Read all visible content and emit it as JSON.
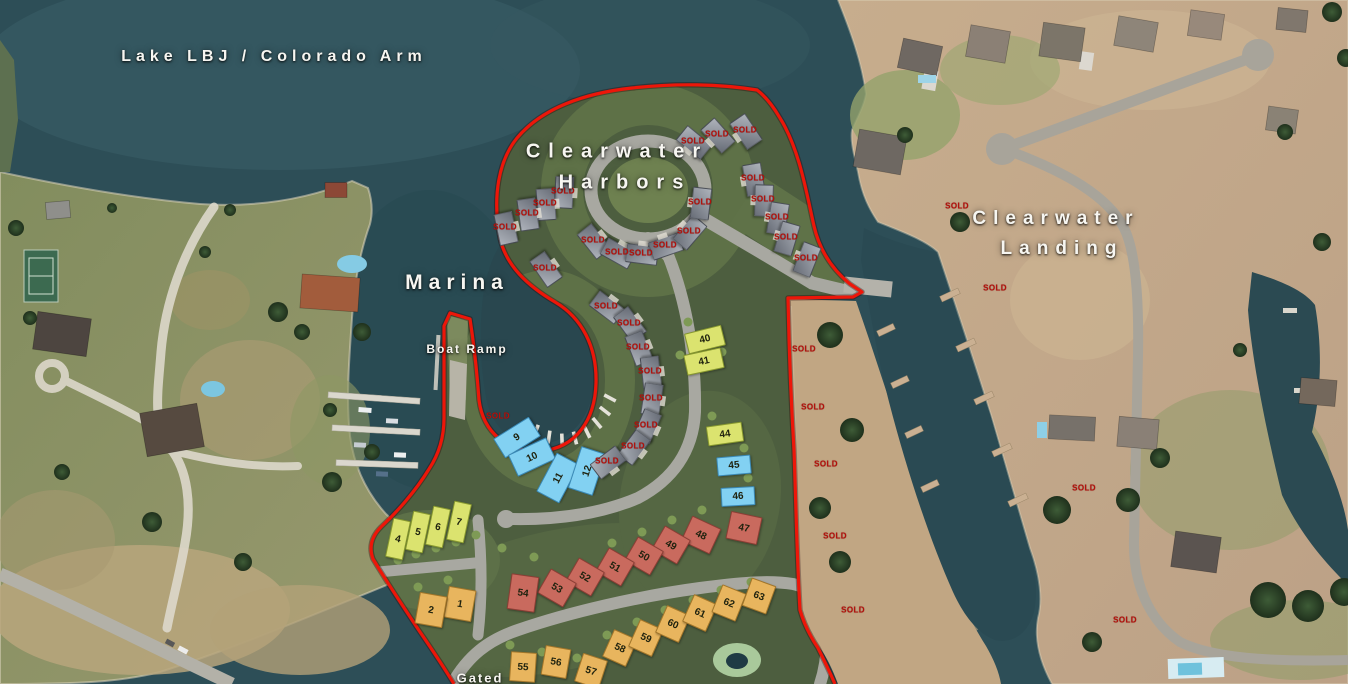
{
  "title_labels": [
    {
      "id": "lake-name",
      "text": "Lake LBJ / Colorado Arm",
      "x": 274,
      "y": 57,
      "fs": 16,
      "ls": 5
    },
    {
      "id": "harbors-line1",
      "text": "Clearwater",
      "x": 617,
      "y": 152,
      "fs": 20,
      "ls": 8
    },
    {
      "id": "harbors-line2",
      "text": "Harbors",
      "x": 625,
      "y": 183,
      "fs": 20,
      "ls": 8
    },
    {
      "id": "landing-line1",
      "text": "Clearwater",
      "x": 1056,
      "y": 219,
      "fs": 19,
      "ls": 7
    },
    {
      "id": "landing-line2",
      "text": "Landing",
      "x": 1062,
      "y": 249,
      "fs": 19,
      "ls": 7
    },
    {
      "id": "marina",
      "text": "Marina",
      "x": 457,
      "y": 283,
      "fs": 21,
      "ls": 6
    },
    {
      "id": "boat-ramp",
      "text": "Boat Ramp",
      "x": 467,
      "y": 349,
      "fs": 12,
      "ls": 2
    },
    {
      "id": "gated",
      "text": "Gated",
      "x": 480,
      "y": 678,
      "fs": 13,
      "ls": 2
    }
  ],
  "sold": {
    "text": "SOLD",
    "labels": [
      {
        "x": 693,
        "y": 141,
        "cluster": "circle"
      },
      {
        "x": 717,
        "y": 134,
        "cluster": "circle"
      },
      {
        "x": 745,
        "y": 130,
        "cluster": "circle"
      },
      {
        "x": 563,
        "y": 191,
        "cluster": "circle"
      },
      {
        "x": 545,
        "y": 203,
        "cluster": "circle"
      },
      {
        "x": 527,
        "y": 213,
        "cluster": "circle"
      },
      {
        "x": 505,
        "y": 227,
        "cluster": "circle"
      },
      {
        "x": 593,
        "y": 240,
        "cluster": "circle"
      },
      {
        "x": 617,
        "y": 252,
        "cluster": "circle"
      },
      {
        "x": 641,
        "y": 253,
        "cluster": "circle"
      },
      {
        "x": 665,
        "y": 245,
        "cluster": "circle"
      },
      {
        "x": 689,
        "y": 231,
        "cluster": "circle"
      },
      {
        "x": 700,
        "y": 202,
        "cluster": "circle"
      },
      {
        "x": 753,
        "y": 178,
        "cluster": "circle"
      },
      {
        "x": 763,
        "y": 199,
        "cluster": "circle"
      },
      {
        "x": 777,
        "y": 217,
        "cluster": "circle"
      },
      {
        "x": 786,
        "y": 237,
        "cluster": "circle"
      },
      {
        "x": 806,
        "y": 258,
        "cluster": "circle"
      },
      {
        "x": 545,
        "y": 268,
        "cluster": "circle"
      },
      {
        "x": 606,
        "y": 306,
        "cluster": "basin"
      },
      {
        "x": 629,
        "y": 323,
        "cluster": "basin"
      },
      {
        "x": 638,
        "y": 347,
        "cluster": "basin"
      },
      {
        "x": 650,
        "y": 371,
        "cluster": "basin"
      },
      {
        "x": 651,
        "y": 398,
        "cluster": "basin"
      },
      {
        "x": 646,
        "y": 425,
        "cluster": "basin"
      },
      {
        "x": 633,
        "y": 446,
        "cluster": "basin"
      },
      {
        "x": 607,
        "y": 461,
        "cluster": "basin"
      },
      {
        "x": 498,
        "y": 416,
        "cluster": "none"
      },
      {
        "x": 804,
        "y": 349,
        "cluster": "none"
      },
      {
        "x": 813,
        "y": 407,
        "cluster": "none"
      },
      {
        "x": 826,
        "y": 464,
        "cluster": "none"
      },
      {
        "x": 835,
        "y": 536,
        "cluster": "none"
      },
      {
        "x": 853,
        "y": 610,
        "cluster": "none"
      },
      {
        "x": 957,
        "y": 206,
        "cluster": "none"
      },
      {
        "x": 995,
        "y": 288,
        "cluster": "none"
      },
      {
        "x": 1084,
        "y": 488,
        "cluster": "none"
      },
      {
        "x": 1125,
        "y": 620,
        "cluster": "none"
      }
    ]
  },
  "lot_colors": {
    "green": {
      "fill": "#dbe36f",
      "edge": "#87982f"
    },
    "blue": {
      "fill": "#82d1f2",
      "edge": "#3a89b6"
    },
    "red": {
      "fill": "#c96a5e",
      "edge": "#8c3e35"
    },
    "orange": {
      "fill": "#e8b55e",
      "edge": "#a2762a"
    }
  },
  "lots": [
    {
      "num": "1",
      "color": "orange",
      "x": 459,
      "y": 603,
      "w": 26,
      "h": 30,
      "rot": 10
    },
    {
      "num": "2",
      "color": "orange",
      "x": 430,
      "y": 609,
      "w": 26,
      "h": 30,
      "rot": 10
    },
    {
      "num": "4",
      "color": "green",
      "x": 397,
      "y": 538,
      "w": 16,
      "h": 38,
      "rot": 12
    },
    {
      "num": "5",
      "color": "green",
      "x": 417,
      "y": 531,
      "w": 16,
      "h": 38,
      "rot": 12
    },
    {
      "num": "6",
      "color": "green",
      "x": 437,
      "y": 526,
      "w": 16,
      "h": 38,
      "rot": 12
    },
    {
      "num": "7",
      "color": "green",
      "x": 458,
      "y": 521,
      "w": 16,
      "h": 38,
      "rot": 12
    },
    {
      "num": "9",
      "color": "blue",
      "x": 516,
      "y": 436,
      "w": 40,
      "h": 21,
      "rot": -32
    },
    {
      "num": "10",
      "color": "blue",
      "x": 531,
      "y": 456,
      "w": 40,
      "h": 22,
      "rot": -25
    },
    {
      "num": "11",
      "color": "blue",
      "x": 557,
      "y": 477,
      "w": 42,
      "h": 24,
      "rot": -62
    },
    {
      "num": "12",
      "color": "blue",
      "x": 586,
      "y": 470,
      "w": 42,
      "h": 24,
      "rot": -72
    },
    {
      "num": "40",
      "color": "green",
      "x": 704,
      "y": 338,
      "w": 36,
      "h": 19,
      "rot": -14
    },
    {
      "num": "41",
      "color": "green",
      "x": 703,
      "y": 360,
      "w": 36,
      "h": 19,
      "rot": -12
    },
    {
      "num": "44",
      "color": "green",
      "x": 724,
      "y": 433,
      "w": 34,
      "h": 18,
      "rot": -8
    },
    {
      "num": "45",
      "color": "blue",
      "x": 733,
      "y": 464,
      "w": 32,
      "h": 17,
      "rot": -5
    },
    {
      "num": "46",
      "color": "blue",
      "x": 737,
      "y": 495,
      "w": 32,
      "h": 17,
      "rot": -3
    },
    {
      "num": "47",
      "color": "red",
      "x": 743,
      "y": 527,
      "w": 30,
      "h": 26,
      "rot": 12
    },
    {
      "num": "48",
      "color": "red",
      "x": 700,
      "y": 534,
      "w": 30,
      "h": 26,
      "rot": 25
    },
    {
      "num": "49",
      "color": "red",
      "x": 670,
      "y": 544,
      "w": 28,
      "h": 26,
      "rot": 30
    },
    {
      "num": "50",
      "color": "red",
      "x": 643,
      "y": 555,
      "w": 28,
      "h": 26,
      "rot": 30
    },
    {
      "num": "51",
      "color": "red",
      "x": 614,
      "y": 566,
      "w": 28,
      "h": 26,
      "rot": 30
    },
    {
      "num": "52",
      "color": "red",
      "x": 584,
      "y": 576,
      "w": 28,
      "h": 26,
      "rot": 30
    },
    {
      "num": "53",
      "color": "red",
      "x": 556,
      "y": 587,
      "w": 28,
      "h": 26,
      "rot": 30
    },
    {
      "num": "54",
      "color": "red",
      "x": 522,
      "y": 592,
      "w": 26,
      "h": 34,
      "rot": 8
    },
    {
      "num": "55",
      "color": "orange",
      "x": 522,
      "y": 666,
      "w": 24,
      "h": 28,
      "rot": 4
    },
    {
      "num": "56",
      "color": "orange",
      "x": 555,
      "y": 661,
      "w": 24,
      "h": 28,
      "rot": 10
    },
    {
      "num": "57",
      "color": "orange",
      "x": 590,
      "y": 670,
      "w": 24,
      "h": 28,
      "rot": 18
    },
    {
      "num": "58",
      "color": "orange",
      "x": 619,
      "y": 647,
      "w": 24,
      "h": 28,
      "rot": 24
    },
    {
      "num": "59",
      "color": "orange",
      "x": 645,
      "y": 637,
      "w": 24,
      "h": 28,
      "rot": 24
    },
    {
      "num": "60",
      "color": "orange",
      "x": 672,
      "y": 623,
      "w": 24,
      "h": 28,
      "rot": 24
    },
    {
      "num": "61",
      "color": "orange",
      "x": 699,
      "y": 612,
      "w": 24,
      "h": 28,
      "rot": 24
    },
    {
      "num": "62",
      "color": "orange",
      "x": 728,
      "y": 602,
      "w": 24,
      "h": 28,
      "rot": 22
    },
    {
      "num": "63",
      "color": "orange",
      "x": 758,
      "y": 595,
      "w": 24,
      "h": 28,
      "rot": 20
    }
  ]
}
